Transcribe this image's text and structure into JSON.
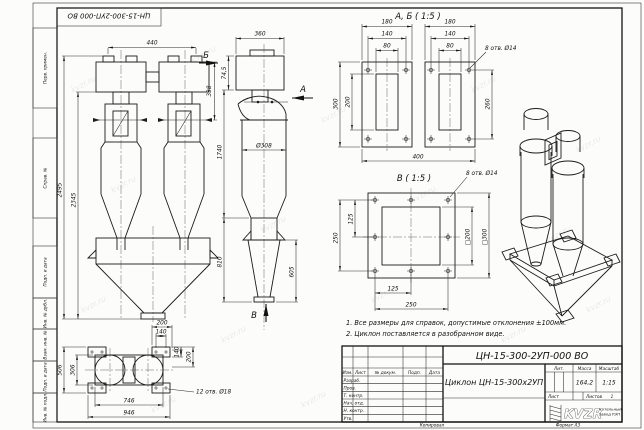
{
  "page": {
    "stamp": "ЦН-15-300-2УП-000 ВО",
    "copied": "Копировал",
    "format": "Формат А3"
  },
  "margin_fields": {
    "f1": "Перв. примен.",
    "f2": "Справ. №",
    "f3": "Подп. и дата",
    "f4": "Инв. № дубл.",
    "f5": "Взам. инв. №",
    "f6": "Подп. и дата",
    "f7": "Инв. № подл."
  },
  "notes": {
    "l1": "1. Все размеры для справок, допустимые отклонения ±100мм.",
    "l2": "2. Циклон поставляется в разобранном виде."
  },
  "views": {
    "front": {
      "d440": "440",
      "d338": "338",
      "d2495": "2495",
      "d2345": "2345"
    },
    "side": {
      "d360": "360",
      "d745": "74,5",
      "d308": "Ø308",
      "d1740": "1740",
      "d810": "810",
      "d605": "605",
      "la": "А",
      "lb": "Б",
      "lv": "В"
    },
    "ab": {
      "title": "А, Б ( 1:5 )",
      "holes": "8 отв. Ø14",
      "d180": "180",
      "d140": "140",
      "d80": "80",
      "d300": "300",
      "d200": "200",
      "d260": "260",
      "d400": "400"
    },
    "v": {
      "title": "В ( 1:5 )",
      "holes": "8 отв. Ø14",
      "d250": "250",
      "d125": "125",
      "sq200": "□200",
      "sq300": "□300"
    },
    "top": {
      "holes": "12 отв. Ø18",
      "d200": "200",
      "d140": "140",
      "d506": "506",
      "d306": "306",
      "d746": "746",
      "d946": "946"
    }
  },
  "title_block": {
    "doc_number": "ЦН-15-300-2УП-000 ВО",
    "name": "Циклон ЦН-15-300х2УП",
    "col_izm": "Изм.",
    "col_list": "Лист",
    "col_doc": "№ докум.",
    "col_podp": "Подп.",
    "col_data": "Дата",
    "row1": "Разраб.",
    "row2": "Пров.",
    "row3": "Т. контр.",
    "row4": "Нач. отд.",
    "row5": "Н. контр.",
    "row6": "Утв.",
    "lit": "Лит.",
    "mass": "Масса",
    "scale": "Масштаб",
    "mass_value": "164,2",
    "scale_value": "1:15",
    "sheet": "Лист",
    "sheets": "Листов",
    "sheets_value": "1",
    "logo": "KVZR",
    "company1": "Котельный",
    "company2": "завод РЭП"
  },
  "watermark": {
    "text": "kvzr.ru",
    "positions": [
      [
        70,
        80
      ],
      [
        190,
        50
      ],
      [
        320,
        110
      ],
      [
        470,
        80
      ],
      [
        575,
        140
      ],
      [
        110,
        180
      ],
      [
        260,
        220
      ],
      [
        410,
        190
      ],
      [
        545,
        230
      ],
      [
        80,
        300
      ],
      [
        220,
        330
      ],
      [
        370,
        290
      ],
      [
        500,
        330
      ],
      [
        150,
        400
      ],
      [
        300,
        395
      ],
      [
        585,
        300
      ]
    ]
  }
}
